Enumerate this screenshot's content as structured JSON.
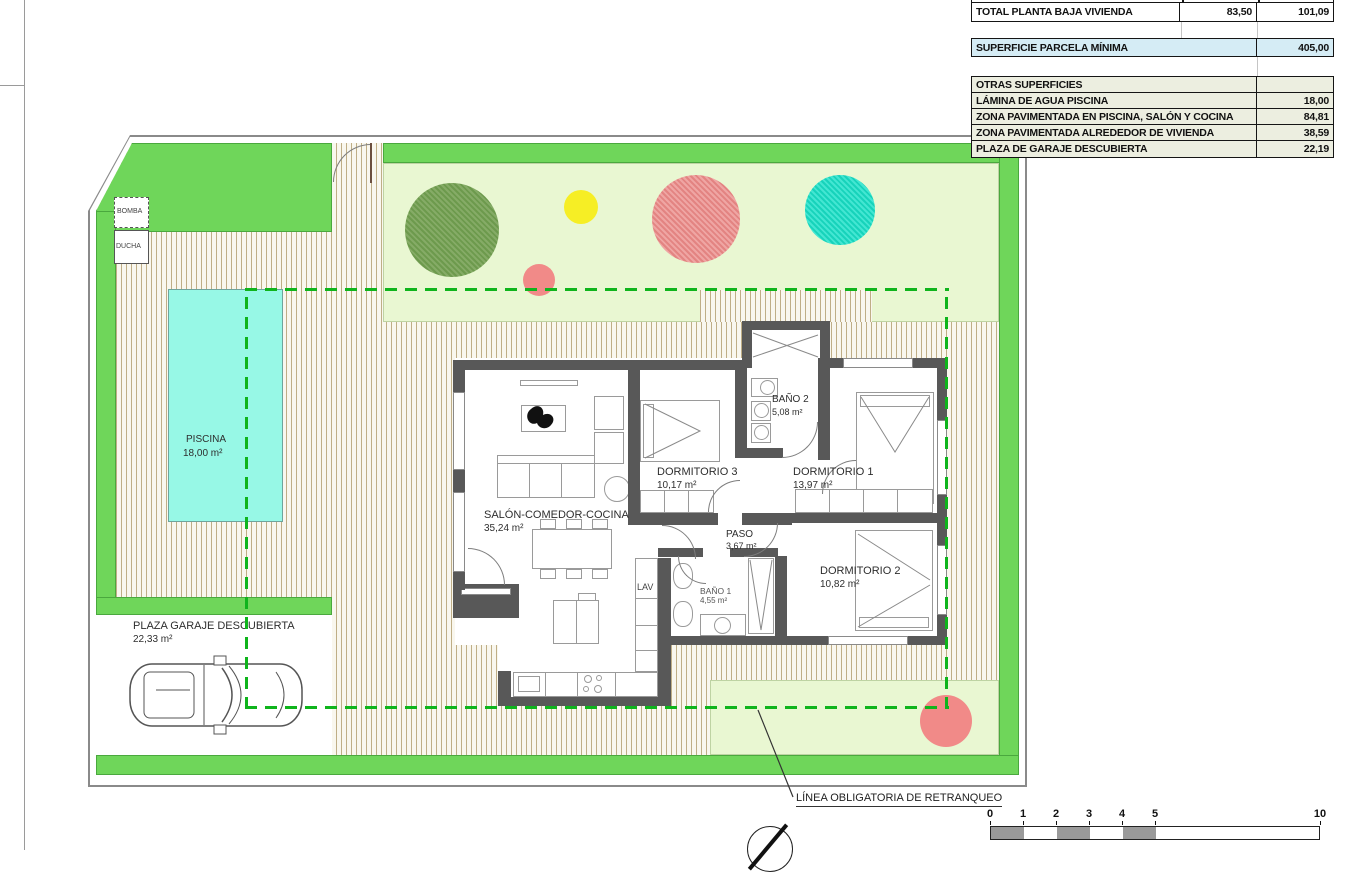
{
  "table": {
    "total_row": {
      "label": "TOTAL PLANTA BAJA VIVIENDA",
      "util": "83,50",
      "built": "101,09"
    },
    "parcela_row": {
      "label": "SUPERFICIE PARCELA MÍNIMA",
      "value": "405,00"
    },
    "otras": {
      "header": "OTRAS SUPERFICIES",
      "rows": [
        {
          "label": "LÁMINA DE AGUA PISCINA",
          "value": "18,00"
        },
        {
          "label": "ZONA PAVIMENTADA EN PISCINA, SALÓN Y COCINA",
          "value": "84,81"
        },
        {
          "label": "ZONA PAVIMENTADA ALREDEDOR DE VIVIENDA",
          "value": "38,59"
        },
        {
          "label": "PLAZA DE GARAJE DESCUBIERTA",
          "value": "22,19"
        }
      ]
    }
  },
  "site": {
    "bomba": "BOMBA",
    "ducha": "DUCHA",
    "lav": "LAV",
    "piscina": {
      "name": "PISCINA",
      "area": "18,00 m²"
    },
    "garaje": {
      "name": "PLAZA GARAJE DESCUBIERTA",
      "area": "22,33 m²"
    },
    "retranqueo_label": "LÍNEA OBLIGATORIA DE RETRANQUEO"
  },
  "rooms": {
    "salon": {
      "name": "SALÓN-COMEDOR-COCINA",
      "area": "35,24 m²"
    },
    "dorm3": {
      "name": "DORMITORIO 3",
      "area": "10,17 m²"
    },
    "dorm1": {
      "name": "DORMITORIO 1",
      "area": "13,97 m²"
    },
    "dorm2": {
      "name": "DORMITORIO 2",
      "area": "10,82 m²"
    },
    "bano2": {
      "name": "BAÑO 2",
      "area": "5,08 m²"
    },
    "bano1": {
      "name": "BAÑO 1",
      "area": "4,55 m²"
    },
    "paso": {
      "name": "PASO",
      "area": "3,67 m²"
    }
  },
  "scalebar": {
    "ticks": [
      "0",
      "1",
      "2",
      "3",
      "4",
      "5",
      "10"
    ]
  },
  "colors": {
    "accent_green": "#6fd65a",
    "garden_green": "#e9f7d2",
    "pool_cyan": "#97f8e6",
    "retranqueo_dash": "#0fb41c",
    "wall_gray": "#585858",
    "table_beige": "#eceee0",
    "table_blue": "#d5ecf5"
  }
}
